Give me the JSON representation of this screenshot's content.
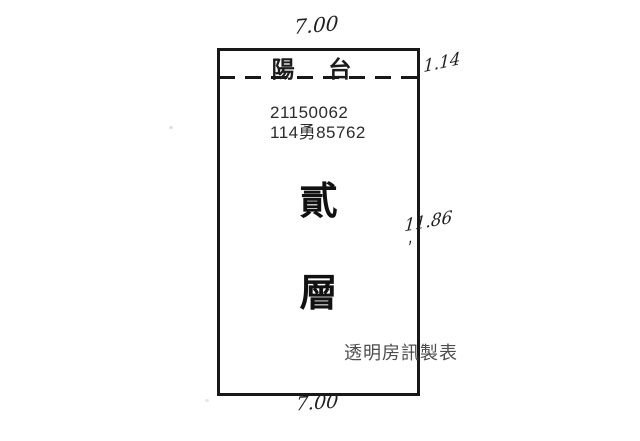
{
  "plan": {
    "balcony_label": "陽 台",
    "id_line1": "21150062",
    "id_line2": "114勇85762",
    "floor_char1": "貳",
    "floor_char2": "層",
    "credit": "透明房訊製表"
  },
  "dimensions": {
    "top_width": "7.00",
    "balcony_depth": "1.14",
    "side_height": "11.86",
    "side_height_tick": ",",
    "bottom_width": "7.00"
  },
  "colors": {
    "line": "#181818",
    "id_text": "#2b2b2b",
    "credit_text": "#4d4d4d",
    "handwriting": "#1f1f1f",
    "background": "#ffffff"
  }
}
